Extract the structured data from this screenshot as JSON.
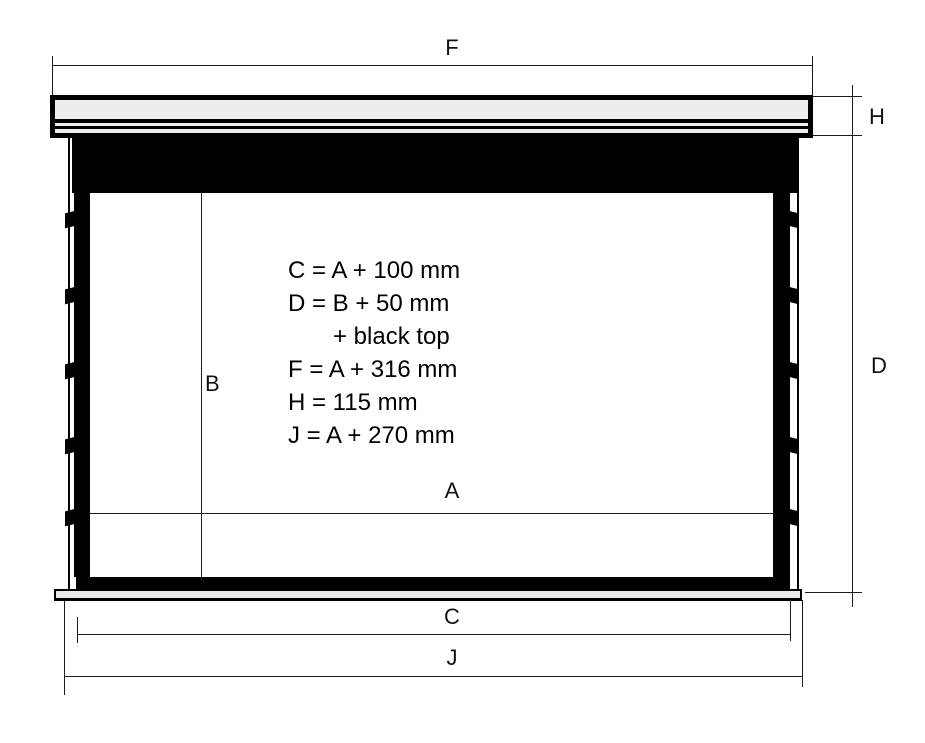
{
  "drawing": {
    "dim_labels": {
      "F": "F",
      "H": "H",
      "D": "D",
      "B": "B",
      "A": "A",
      "C": "C",
      "J": "J"
    },
    "formula_lines": [
      "C = A + 100 mm",
      "D = B + 50 mm",
      "+ black top",
      "F = A + 316 mm",
      "H = 115 mm",
      "J = A + 270 mm"
    ],
    "colors": {
      "line": "#1a1a1a",
      "screen_border": "#000000",
      "casing_fill": "#ededed",
      "weight_bar_fill": "#e9e9e9",
      "background": "#ffffff"
    }
  }
}
